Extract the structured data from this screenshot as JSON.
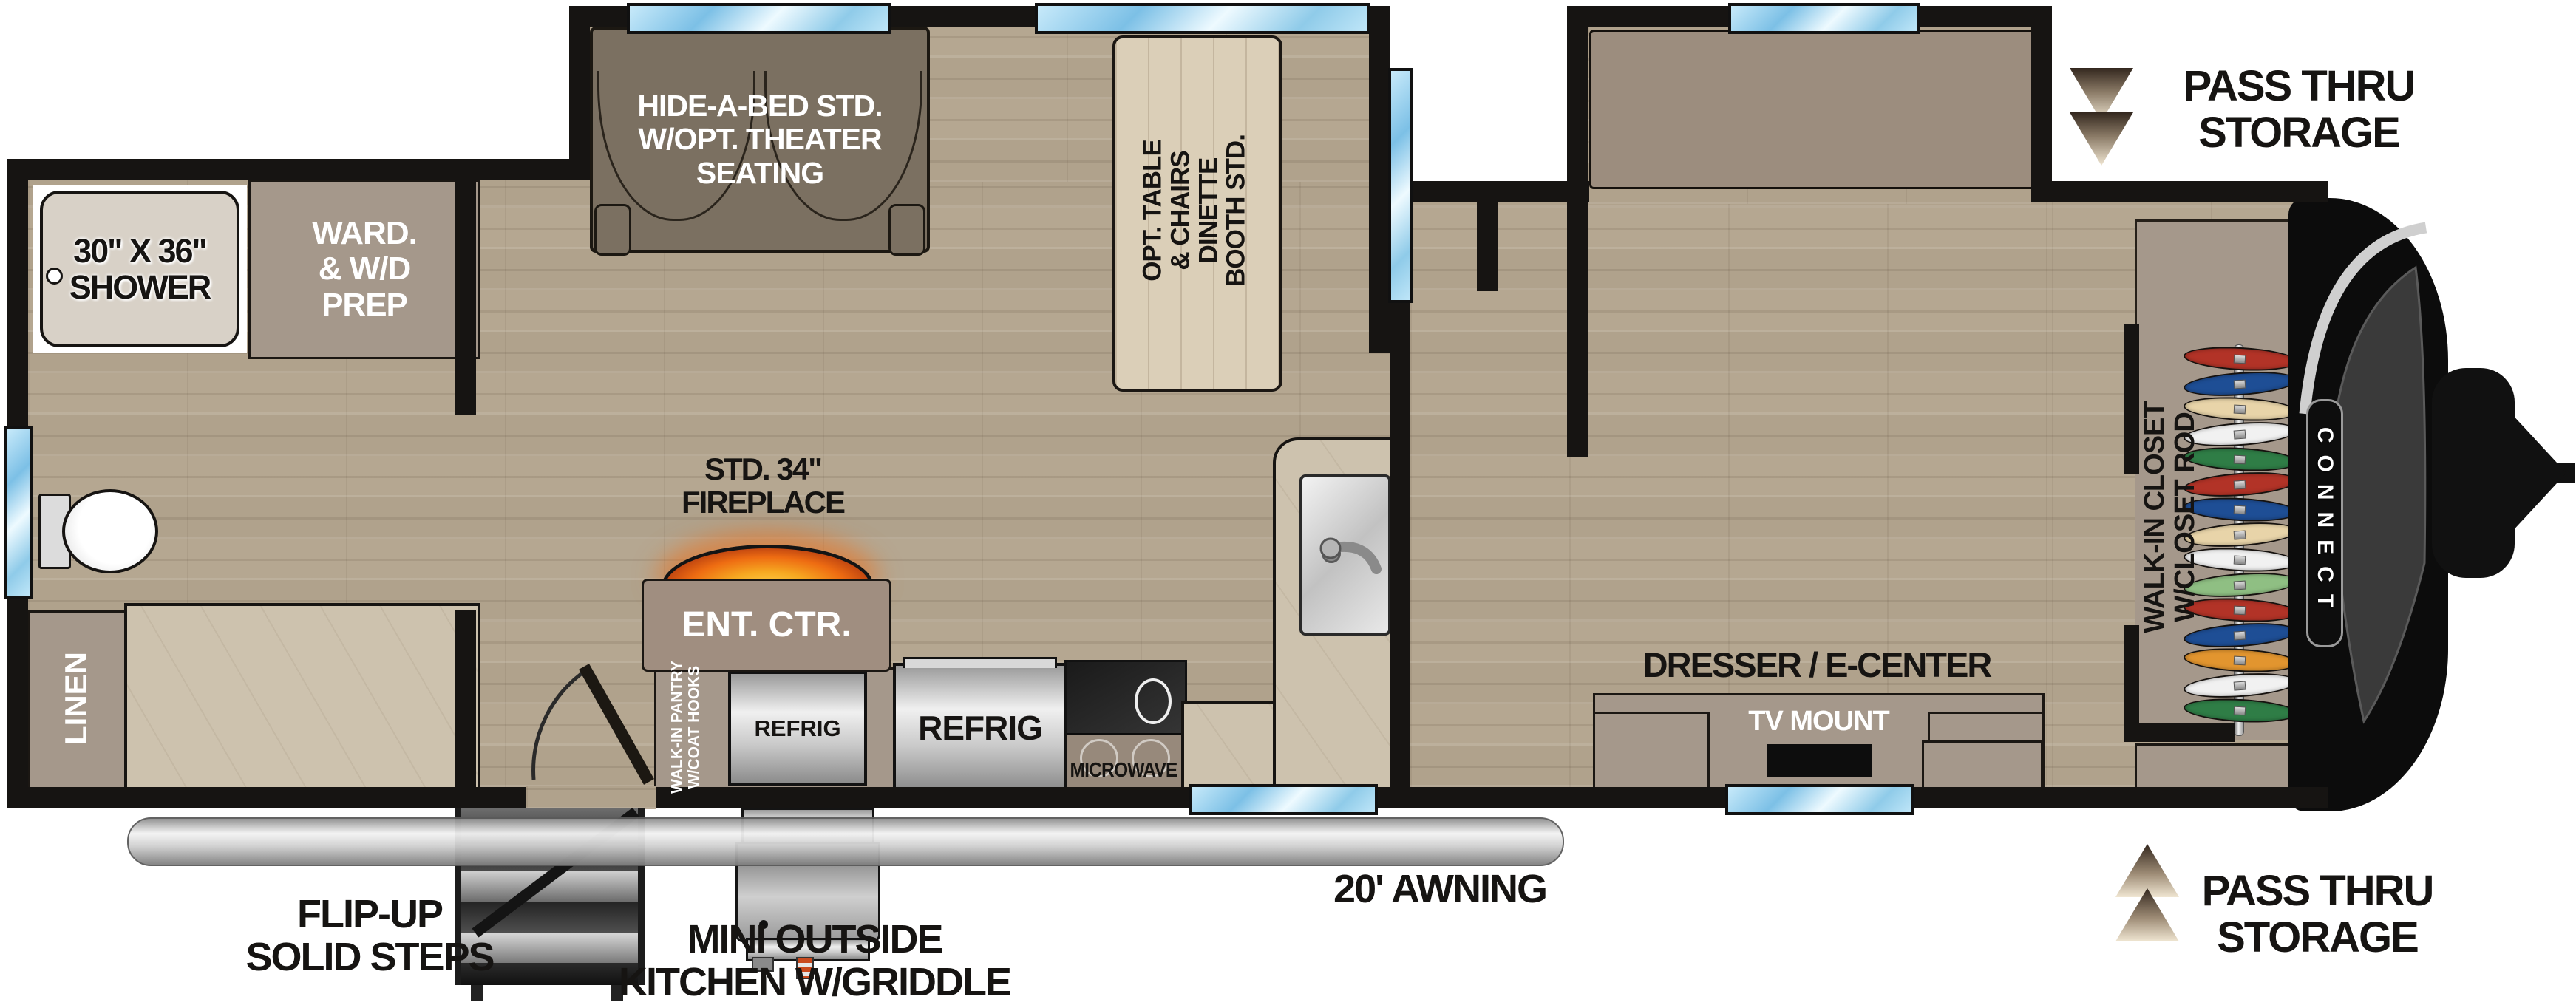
{
  "plan": {
    "brand": "CONNECT",
    "rooms": {
      "shower": {
        "l1": "30\" X 36\"",
        "l2": "SHOWER"
      },
      "wardrobe": {
        "l1": "WARD.",
        "l2": "& W/D",
        "l3": "PREP"
      },
      "linen": "LINEN",
      "sofa": {
        "l1": "HIDE-A-BED STD.",
        "l2": "W/OPT. THEATER",
        "l3": "SEATING"
      },
      "dinette": {
        "l1": "OPT. TABLE",
        "l2": "& CHAIRS",
        "l3": "DINETTE",
        "l4": "BOOTH STD."
      },
      "bed": {
        "l1": "70\" X 80\"",
        "l2": "KING BED"
      },
      "closet": {
        "l1": "WALK-IN CLOSET",
        "l2": "W/CLOSET ROD"
      },
      "dresser": "DRESSER / E-CENTER",
      "tv": "TV MOUNT",
      "pantry": {
        "l1": "WALK-IN PANTRY",
        "l2": "W/COAT HOOKS"
      },
      "ent_ctr": "ENT. CTR.",
      "fireplace": {
        "l1": "STD. 34\"",
        "l2": "FIREPLACE"
      },
      "refrig_inner": "REFRIG",
      "refrig_main": "REFRIG",
      "microwave": "MICROWAVE"
    },
    "callouts": {
      "pass_thru_top": {
        "l1": "PASS THRU",
        "l2": "STORAGE"
      },
      "pass_thru_bottom": {
        "l1": "PASS THRU",
        "l2": "STORAGE"
      },
      "awning": "20' AWNING",
      "steps": {
        "l1": "FLIP-UP",
        "l2": "SOLID STEPS"
      },
      "outside_kitchen": {
        "l1": "MINI OUTSIDE",
        "l2": "KITCHEN W/GRIDDLE"
      }
    },
    "colors": {
      "wall": "#161412",
      "window_blue": "#a8d8f0",
      "cabinet_tan": "#a5988b",
      "wood_floor": "#b5a791",
      "counter": "#cdc2ae",
      "sofa_brown": "#7b7061",
      "chair_gray": "#8d857b",
      "bed_blanket": "#434445",
      "fireplace_glow": "#ee6c12",
      "hanger_colors": [
        "#b23327",
        "#1e4e95",
        "#e8d4a9",
        "#f1f1f1",
        "#2f7d46",
        "#b23327",
        "#1e4e95",
        "#e8d4a9",
        "#f1f1f1",
        "#8fbf83",
        "#b23327",
        "#1e4e95",
        "#e2952f",
        "#f1f1f1",
        "#2f7d46"
      ]
    }
  }
}
